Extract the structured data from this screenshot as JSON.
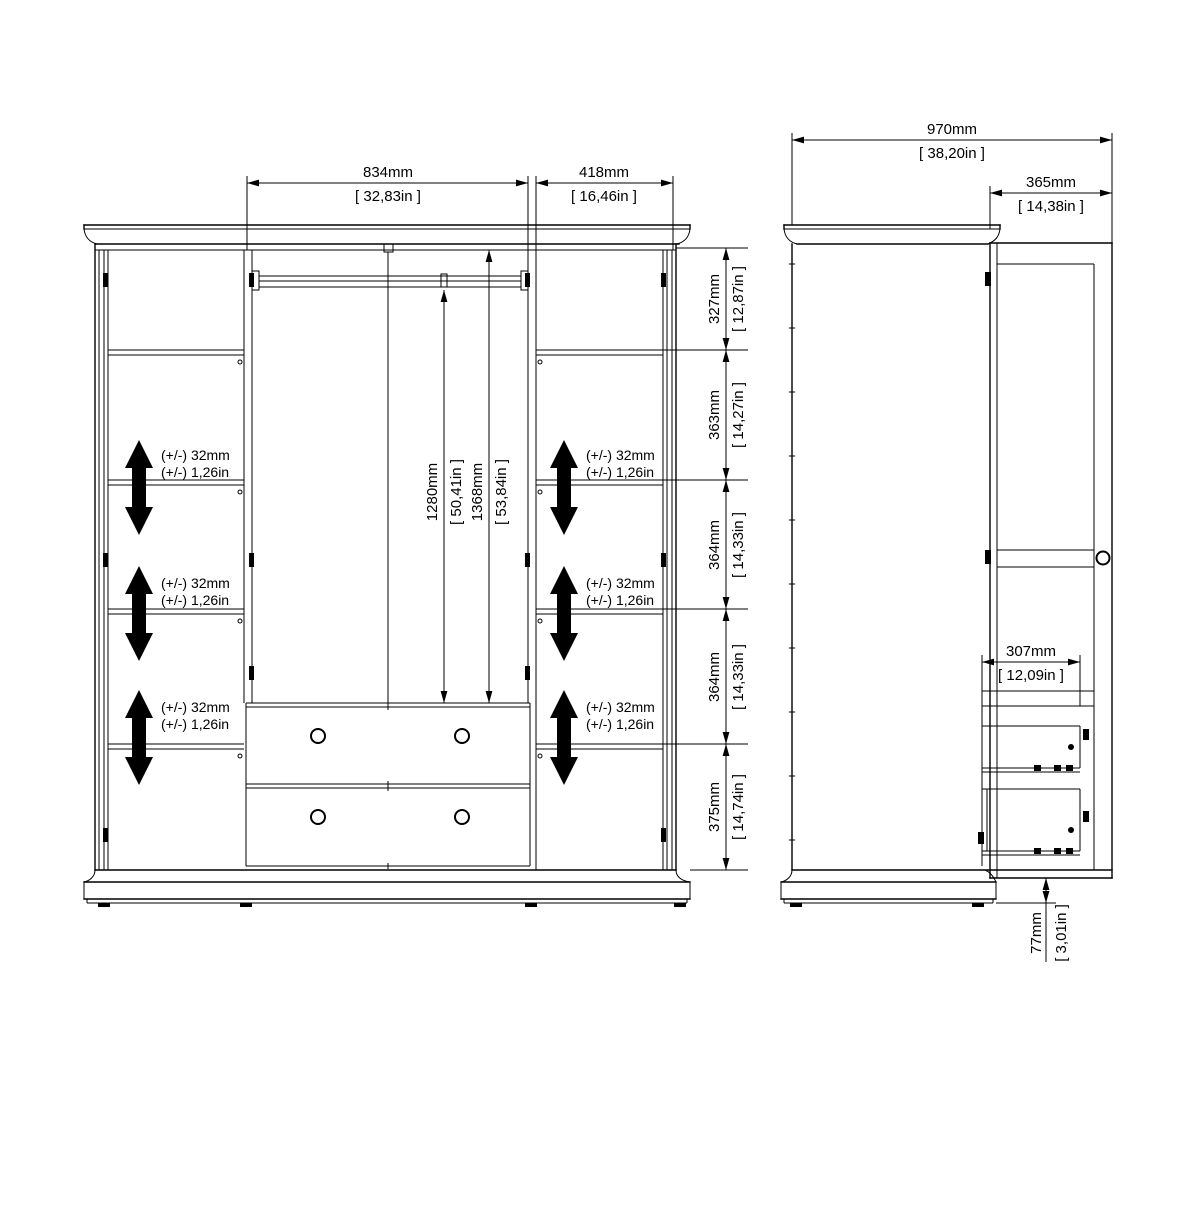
{
  "front_view": {
    "width_dims": [
      {
        "mm": "834mm",
        "in": "[ 32,83in ]"
      },
      {
        "mm": "418mm",
        "in": "[ 16,46in ]"
      }
    ],
    "height_dims": [
      {
        "mm": "327mm",
        "in": "[ 12,87in ]"
      },
      {
        "mm": "363mm",
        "in": "[ 14,27in ]"
      },
      {
        "mm": "364mm",
        "in": "[ 14,33in ]"
      },
      {
        "mm": "364mm",
        "in": "[ 14,33in ]"
      },
      {
        "mm": "375mm",
        "in": "[ 14,74in ]"
      }
    ],
    "interior_height_dims": [
      {
        "mm": "1280mm",
        "in": "[ 50,41in ]"
      },
      {
        "mm": "1368mm",
        "in": "[ 53,84in ]"
      }
    ],
    "shelf_adjust_labels": [
      {
        "mm": "(+/-) 32mm",
        "in": "(+/-) 1,26in"
      },
      {
        "mm": "(+/-) 32mm",
        "in": "(+/-) 1,26in"
      },
      {
        "mm": "(+/-) 32mm",
        "in": "(+/-) 1,26in"
      },
      {
        "mm": "(+/-) 32mm",
        "in": "(+/-) 1,26in"
      },
      {
        "mm": "(+/-) 32mm",
        "in": "(+/-) 1,26in"
      },
      {
        "mm": "(+/-) 32mm",
        "in": "(+/-) 1,26in"
      }
    ]
  },
  "side_view": {
    "depth_dim": {
      "mm": "970mm",
      "in": "[ 38,20in ]"
    },
    "door_depth_dim": {
      "mm": "365mm",
      "in": "[ 14,38in ]"
    },
    "drawer_depth_dim": {
      "mm": "307mm",
      "in": "[ 12,09in ]"
    },
    "plinth_height_dim": {
      "mm": "77mm",
      "in": "[ 3,01in ]"
    }
  },
  "colors": {
    "line": "#000000",
    "background": "#ffffff"
  }
}
